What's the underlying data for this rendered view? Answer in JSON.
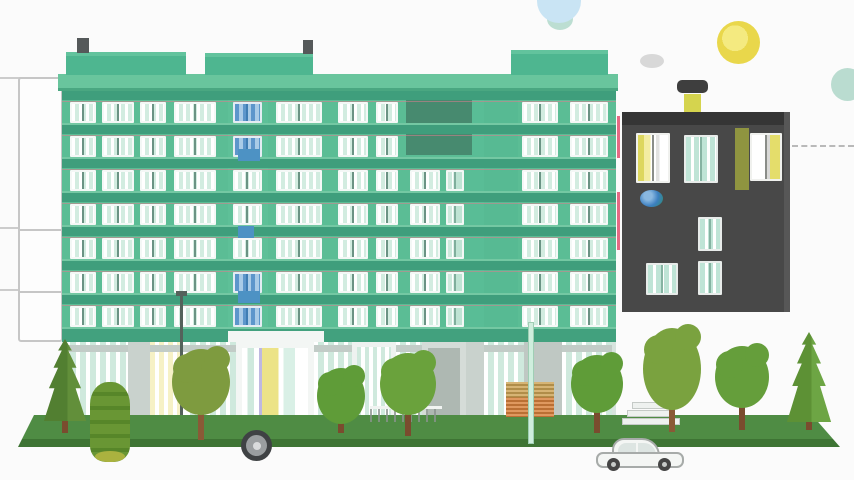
{
  "meta": {
    "label": "flat-illustration-apartment-buildings-street",
    "canvas": {
      "w": 854,
      "h": 480
    },
    "background": "#fbfbfb"
  },
  "left_guides": {
    "color": "#cccccc",
    "x": 0,
    "w": 62,
    "lines": [
      77,
      227,
      289
    ]
  },
  "back_tower": {
    "x": 18,
    "y": 77,
    "w": 45,
    "h": 265,
    "fill": "#fdfdfd",
    "border": "#c6c6c6",
    "dividers": [
      150,
      212
    ]
  },
  "sky": {
    "items": [
      {
        "name": "sky-circle-teal-small",
        "shape": "circle",
        "x": 547,
        "y": 8,
        "w": 26,
        "h": 22,
        "color": "#bcded2"
      },
      {
        "name": "sky-circle-blue",
        "shape": "circle",
        "x": 537,
        "y": -21,
        "w": 44,
        "h": 44,
        "color": "#c9e4f4"
      },
      {
        "name": "cloud-blob",
        "shape": "circle",
        "x": 640,
        "y": 54,
        "w": 24,
        "h": 14,
        "color": "#d8d8d8"
      },
      {
        "name": "floating-dark-capsule",
        "shape": "rect",
        "x": 677,
        "y": 80,
        "w": 31,
        "h": 13,
        "r": 5,
        "color": "#3e3e3e"
      },
      {
        "name": "sun",
        "shape": "circle",
        "x": 717,
        "y": 21,
        "w": 43,
        "h": 43,
        "color": "radial-gradient(circle at 42% 40%, #f4ea80 0 36%, #e9d74b 36% 82%, #e2c655 82% 100%)"
      },
      {
        "name": "sky-circle-teal",
        "shape": "circle",
        "x": 831,
        "y": 68,
        "w": 33,
        "h": 33,
        "color": "#badcd0"
      }
    ]
  },
  "dark_building": {
    "body": {
      "x": 622,
      "y": 112,
      "w": 168,
      "h": 200,
      "color": "#484848"
    },
    "roof_band": {
      "h": 13,
      "color": "#353535"
    },
    "right_edge": {
      "w": 6,
      "color": "#575757"
    },
    "chimney": {
      "x": 684,
      "y": 94,
      "w": 17,
      "h": 18,
      "color": "#d5d44e"
    },
    "olive_streak": {
      "x": 735,
      "y": 128,
      "w": 14,
      "h": 62,
      "color": "#8f9440"
    },
    "windows": [
      {
        "x": 636,
        "y": 133,
        "w": 34,
        "h": 50,
        "style": "lit_left"
      },
      {
        "x": 684,
        "y": 135,
        "w": 34,
        "h": 48,
        "style": "teal_dark"
      },
      {
        "x": 750,
        "y": 133,
        "w": 32,
        "h": 48,
        "style": "lit_right"
      },
      {
        "x": 698,
        "y": 217,
        "w": 24,
        "h": 34,
        "style": "teal_dark"
      },
      {
        "x": 646,
        "y": 263,
        "w": 32,
        "h": 32,
        "style": "teal_dark"
      },
      {
        "x": 698,
        "y": 261,
        "w": 24,
        "h": 34,
        "style": "teal_dark"
      }
    ],
    "blue_ball": {
      "x": 640,
      "y": 190,
      "w": 23,
      "h": 17,
      "color": "radial-gradient(circle at 35% 35%, #8ab8e0 0 22%, #3c7fc0 55%, #2d8e6e 100%)"
    },
    "pink_stripes": [
      {
        "x": 617,
        "y": 116,
        "w": 3,
        "h": 42
      },
      {
        "x": 617,
        "y": 192,
        "w": 3,
        "h": 58
      }
    ],
    "pink_color": "#e56a84",
    "dashed_line": {
      "x": 792,
      "y": 145,
      "w": 62,
      "color": "#b9b9b9"
    }
  },
  "main_building": {
    "facade": {
      "x": 62,
      "y": 91,
      "w": 554,
      "h": 339,
      "color": "#5bbd95"
    },
    "roof_slab": {
      "x": 58,
      "y": 74,
      "w": 560,
      "h": 17,
      "color": "#69c59d",
      "shadow": "#4aa781"
    },
    "parapet_color": "#4eb690",
    "parapet_top": "#62c39d",
    "parapets": [
      {
        "x": 66,
        "y": 52,
        "w": 120,
        "h": 23
      },
      {
        "x": 205,
        "y": 53,
        "w": 108,
        "h": 22
      },
      {
        "x": 511,
        "y": 50,
        "w": 97,
        "h": 25
      }
    ],
    "chimney_color": "#55595a",
    "chimneys": [
      {
        "x": 77,
        "y": 38,
        "w": 12,
        "h": 15
      },
      {
        "x": 303,
        "y": 40,
        "w": 10,
        "h": 14
      }
    ],
    "stair_strip": {
      "x": 228,
      "y": 91,
      "w": 40,
      "color": "#5ec098"
    },
    "accent_strip": {
      "x": 470,
      "y": 91,
      "w": 16,
      "color": "#59bd96"
    },
    "plain_column": {
      "x": 484,
      "y": 91,
      "w": 34,
      "color": "#57ba93"
    },
    "dark_panel": {
      "x": 406,
      "y": 91,
      "w": 66,
      "h": 64,
      "color": "#478a6f"
    },
    "floors": {
      "count": 7,
      "top": 91,
      "row_h": 34,
      "spandrel_h": 9,
      "spandrel_color": "#3f9e7c",
      "win_offset": 11,
      "win_h": 21,
      "sill_color": "#74c8a3",
      "accent_line": "rgba(219,126,142,0.55)"
    },
    "window_columns": [
      {
        "x": 70,
        "w": 26,
        "style": "std",
        "from": 0
      },
      {
        "x": 102,
        "w": 32,
        "style": "std",
        "from": 0
      },
      {
        "x": 140,
        "w": 26,
        "style": "std",
        "from": 0
      },
      {
        "x": 174,
        "w": 42,
        "style": "std",
        "from": 0
      },
      {
        "x": 276,
        "w": 46,
        "style": "std",
        "from": 0
      },
      {
        "x": 338,
        "w": 30,
        "style": "std",
        "from": 0
      },
      {
        "x": 376,
        "w": 22,
        "style": "std",
        "from": 0
      },
      {
        "x": 410,
        "w": 30,
        "style": "std",
        "from": 2
      },
      {
        "x": 446,
        "w": 18,
        "style": "teal",
        "from": 2
      },
      {
        "x": 522,
        "w": 36,
        "style": "std",
        "from": 0
      },
      {
        "x": 570,
        "w": 38,
        "style": "std",
        "from": 0
      }
    ],
    "stair_column": {
      "x": 233,
      "w": 29,
      "blue_floors": [
        0,
        1,
        5,
        6
      ]
    },
    "blue_accents": [
      {
        "x": 238,
        "y": 149,
        "w": 22,
        "h": 12
      },
      {
        "x": 238,
        "y": 226,
        "w": 16,
        "h": 12
      },
      {
        "x": 238,
        "y": 291,
        "w": 22,
        "h": 12
      }
    ],
    "blue_accent_color": "#4d92c4",
    "ground_floor": {
      "fascia": {
        "x": 62,
        "y": 329,
        "w": 554,
        "h": 13,
        "color": "#42a17e"
      },
      "area": {
        "x": 62,
        "y": 342,
        "w": 554,
        "h": 82,
        "color": "#d7e4de"
      },
      "canopy": {
        "x": 228,
        "y": 331,
        "w": 96,
        "h": 11,
        "color": "#f3f6f4"
      },
      "baseline": {
        "x": 62,
        "y": 424,
        "w": 554,
        "h": 6,
        "color": "#bac7c0"
      },
      "transom_color": "#c2ccc7",
      "segments": [
        {
          "x": 66,
          "to": 128,
          "type": "glass"
        },
        {
          "x": 128,
          "to": 150,
          "type": "wall"
        },
        {
          "x": 150,
          "to": 186,
          "type": "lit"
        },
        {
          "x": 186,
          "to": 236,
          "type": "glass"
        },
        {
          "x": 236,
          "to": 314,
          "type": "door_main"
        },
        {
          "x": 314,
          "to": 352,
          "type": "glass"
        },
        {
          "x": 352,
          "to": 396,
          "type": "door_white"
        },
        {
          "x": 396,
          "to": 422,
          "type": "glass"
        },
        {
          "x": 422,
          "to": 466,
          "type": "door_gray"
        },
        {
          "x": 466,
          "to": 484,
          "type": "wall"
        },
        {
          "x": 484,
          "to": 524,
          "type": "glass"
        },
        {
          "x": 524,
          "to": 562,
          "type": "wall_gray"
        },
        {
          "x": 562,
          "to": 612,
          "type": "glass"
        }
      ]
    }
  },
  "window_styles": {
    "std": {
      "frame": "#f4f8f6",
      "glass": "repeating-linear-gradient(90deg, #ffffff 0 3px, #d2ece0 3px 7px)",
      "mullion": "#6b9384"
    },
    "teal": {
      "frame": "#f4f8f6",
      "glass": "linear-gradient(90deg, #cdeadd 0 30%, #ffffff 30% 38%, #bfe4d4 38% 100%)",
      "mullion": "#7fae9c"
    },
    "blue": {
      "frame": "#e4ecf3",
      "glass": "repeating-linear-gradient(90deg, #5d96cb 0 4px, #a9cbe7 4px 8px)",
      "mullion": "#3f7db3"
    },
    "lit_left": {
      "frame": "#f0f1ee",
      "glass": "linear-gradient(90deg, #ddd75e 0 20%, #f3eda2 20% 42%, #ffffff 42% 60%, #e2e2e0 60% 72%, #ffffff 72% 100%)",
      "mullion": "#8a8d88"
    },
    "lit_right": {
      "frame": "#f0f1ee",
      "glass": "linear-gradient(90deg, #ffffff 0 52%, #d9d9d7 52% 64%, #e4dd6b 64% 100%)",
      "mullion": "#8a8d88"
    },
    "teal_dark": {
      "frame": "#e8ecea",
      "glass": "repeating-linear-gradient(90deg, #bfe4d6 0 5px, #ffffff 5px 8px)",
      "mullion": "#86b3a2"
    }
  },
  "ground_styles": {
    "glass": {
      "bg": "repeating-linear-gradient(90deg, #ffffff 0 4px, #cfe9dd 4px 10px)"
    },
    "wall": {
      "bg": "#c9d2cd"
    },
    "wall_gray": {
      "bg": "#bfc8c3"
    },
    "lit": {
      "bg": "repeating-linear-gradient(90deg, #f6f1c6 0 5px, #ffffff 5px 9px)"
    },
    "door_main": {
      "bg": "#f3f6f4",
      "inner": "linear-gradient(90deg, #ffffff 0 8%, #cfe9dd 8% 18%, #ffffff 18% 26%, #beb8e0 26% 30%, #ece387 30% 55%, #ffffff 55% 63%, #d9f0e6 63% 80%, #ffffff 80% 100%)",
      "inset": 6
    },
    "door_white": {
      "bg": "#eef2f0",
      "inner": "repeating-linear-gradient(90deg, #cfe9dd 0 4px, #ffffff 4px 8px)",
      "inset": 5
    },
    "door_gray": {
      "bg": "#d5dcd8",
      "inner": "#aeb8b2",
      "inset": 6
    }
  },
  "street": {
    "grass": {
      "x": 14,
      "y": 415,
      "w": 828,
      "h": 32,
      "clip": "polygon(20px 0px, 798px 0px, 826px 32px, 4px 32px)",
      "top_color": "#4f8c44",
      "edge_color": "#3e7434"
    },
    "planter": {
      "x": 506,
      "y": 382,
      "w": 48,
      "h": 35,
      "top": "#cda455",
      "bottom": "#d8813c"
    },
    "light_strip": {
      "x": 528,
      "y": 322,
      "w": 6,
      "h": 122,
      "color": "#cfeedd",
      "border": "#9fceb4"
    },
    "lamp_pole": {
      "x": 180,
      "y": 296,
      "w": 3,
      "h": 128,
      "color": "#54625b",
      "head_w": 11,
      "head_h": 5
    },
    "fence": {
      "x": 370,
      "y": 406,
      "w": 72,
      "h": 16,
      "rail": "#f1f4f2",
      "picket": "#8a938e"
    },
    "steps": {
      "x": 622,
      "y": 402,
      "w": 58,
      "bars": 3,
      "bar_h": 7,
      "color": "#eef1ef",
      "border": "#c5cac7"
    }
  },
  "tree_shapes": {
    "pine_clip": "polygon(50% 0%, 65% 14%, 57% 14%, 75% 35%, 65% 35%, 85% 60%, 73% 60%, 96% 100%, 4% 100%, 27% 60%, 15% 60%, 35% 35%, 25% 35%, 43% 14%, 35% 14%)"
  },
  "trees": [
    {
      "type": "pine",
      "cx": 65,
      "base": 433,
      "w": 46,
      "h": 82,
      "trunk_h": 16,
      "color": "#527f31",
      "color2": "#628f3a",
      "trunk": "#7a4c2e"
    },
    {
      "type": "bush",
      "cx": 110,
      "base": 462,
      "w": 40,
      "h": 80,
      "color": "#699634",
      "stripe": "#578629",
      "blob": "#aab23f"
    },
    {
      "type": "round",
      "cx": 201,
      "base": 440,
      "w": 58,
      "h": 66,
      "cy": 382,
      "color": "#7e9b3f",
      "trunk": "#8a5a36"
    },
    {
      "type": "round",
      "cx": 341,
      "base": 433,
      "w": 48,
      "h": 56,
      "cy": 396,
      "color": "#5f9c38",
      "trunk": "#7a4c2e"
    },
    {
      "type": "round",
      "cx": 408,
      "base": 436,
      "w": 56,
      "h": 62,
      "cy": 384,
      "color": "#6aa23c",
      "trunk": "#7a4c2e"
    },
    {
      "type": "round",
      "cx": 597,
      "base": 433,
      "w": 52,
      "h": 58,
      "cy": 384,
      "color": "#5f9c38",
      "trunk": "#7a4c2e"
    },
    {
      "type": "round",
      "cx": 672,
      "base": 432,
      "w": 58,
      "h": 82,
      "cy": 369,
      "color": "#7aa23f",
      "trunk": "#8a5a36"
    },
    {
      "type": "round",
      "cx": 742,
      "base": 430,
      "w": 54,
      "h": 62,
      "cy": 377,
      "color": "#659e3b",
      "trunk": "#7a4c2e"
    },
    {
      "type": "pine",
      "cx": 809,
      "base": 430,
      "w": 48,
      "h": 90,
      "trunk_h": 12,
      "color": "#5d9135",
      "color2": "#6da544",
      "trunk": "#7a4c2e"
    }
  ],
  "vehicles": {
    "tire": {
      "x": 241,
      "y": 430,
      "d": 31,
      "ring": "#3f4244",
      "mid": "#9a9ea0",
      "core": "#d9dbdc"
    },
    "car": {
      "x": 596,
      "y": 438,
      "w": 88,
      "h": 34,
      "body": "#f4f6f4",
      "outline": "#a7aba9",
      "glass": "#dde5e2",
      "wheel": "#454545",
      "hub": "#c7cbc9",
      "wheel1_cx": 17,
      "wheel2_cx": 68,
      "wheel_cy": 26,
      "wheel_d": 13
    }
  }
}
